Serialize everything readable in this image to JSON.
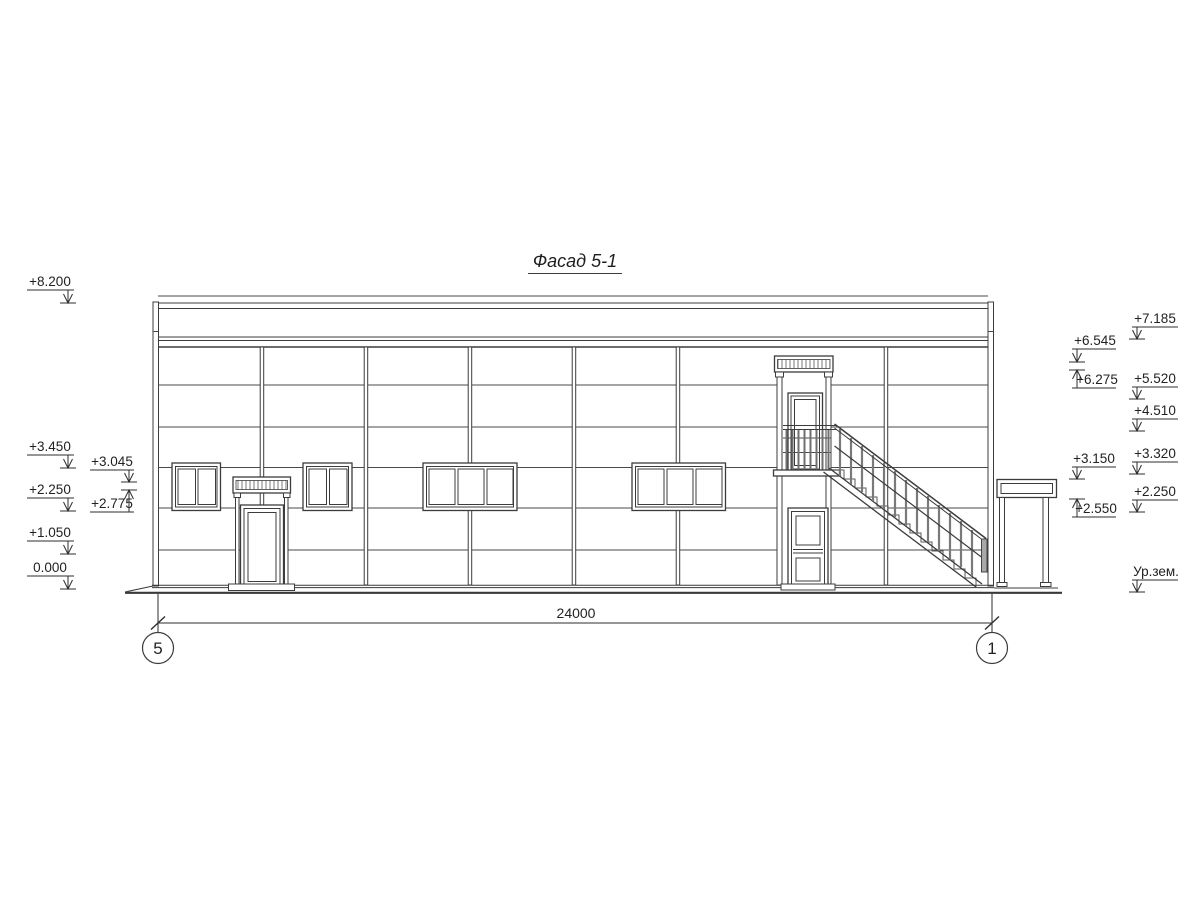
{
  "title": "Фасад 5-1",
  "dimensions": {
    "overall_width": "24000"
  },
  "axes": {
    "left": "5",
    "right": "1"
  },
  "elevations": {
    "left_outer": [
      "+8.200",
      "+3.450",
      "+2.250",
      "+1.050",
      "0.000"
    ],
    "left_inner": [
      "+3.045",
      "+2.775"
    ],
    "right_inner": [
      "+6.545",
      "+6.275",
      "+3.150",
      "+2.550"
    ],
    "right_outer": [
      "+7.185",
      "+5.520",
      "+4.510",
      "+3.320",
      "+2.250",
      "Ур.зем."
    ]
  }
}
